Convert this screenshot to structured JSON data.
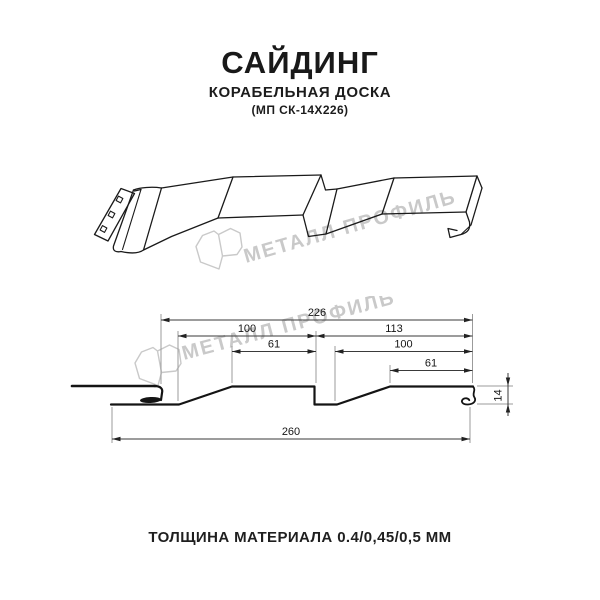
{
  "header": {
    "title": "САЙДИНГ",
    "subtitle": "КОРАБЕЛЬНАЯ ДОСКА",
    "model": "(МП СК-14Х226)"
  },
  "watermark": {
    "text": "МЕТАЛЛ ПРОФИЛЬ",
    "color": "#c9c9c9"
  },
  "drawing": {
    "kind": "siding panel — perspective view and dimensioned cross-section",
    "dimensions_mm": {
      "overall_width": 260,
      "working_width": 226,
      "left_module_width": 100,
      "right_module_width": 113,
      "left_face": 61,
      "right_face": 100,
      "right_inner_face": 61,
      "profile_height": 14
    }
  },
  "section": {
    "dims": {
      "d226": "226",
      "d100L": "100",
      "d113": "113",
      "d61L": "61",
      "d100R": "100",
      "d61R": "61",
      "d260": "260",
      "d14": "14"
    }
  },
  "footer": {
    "text": "ТОЛЩИНА МАТЕРИАЛА 0.4/0,45/0,5 ММ"
  },
  "colors": {
    "background": "#ffffff",
    "line_art": "#1a1a1a",
    "dimension_line": "#3a3a3a",
    "extension_line": "#9b9b9b",
    "watermark": "#c9c9c9"
  }
}
